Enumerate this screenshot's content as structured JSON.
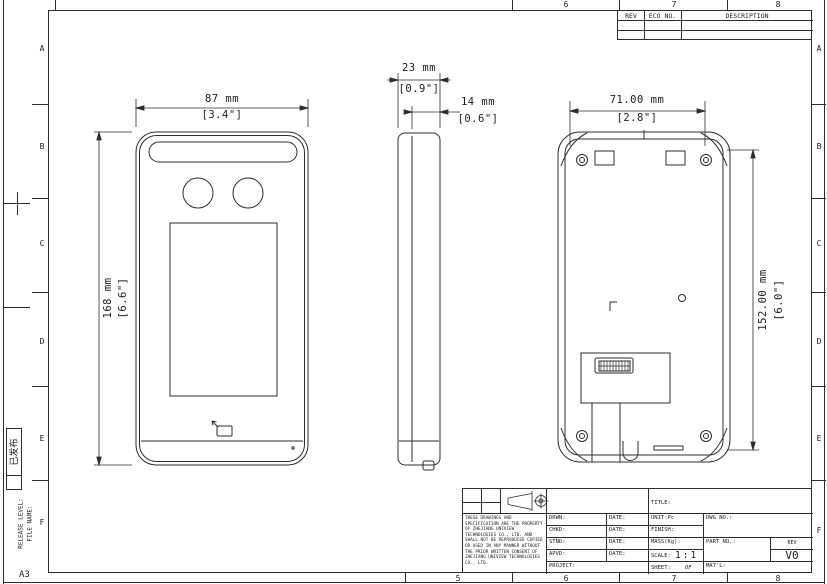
{
  "frame": {
    "sheet_size": "A3",
    "release_stamp": "已发布",
    "release_level": "RELEASE LEVEL:",
    "file_name": "FILE NAME:",
    "zones_top": [
      "6",
      "7",
      "8"
    ],
    "zones_bottom": [
      "5",
      "6",
      "7",
      "8"
    ],
    "zones_left": [
      "A",
      "B",
      "C",
      "D",
      "E",
      "F"
    ],
    "zones_right": [
      "A",
      "B",
      "C",
      "D",
      "E",
      "F"
    ]
  },
  "rev_table": {
    "col_rev": "REV",
    "col_eco": "ECO NO.",
    "col_desc": "DESCRIPTION"
  },
  "dims": {
    "front_width_mm": "87 mm",
    "front_width_in": "[3.4\"]",
    "front_height_mm": "168 mm",
    "front_height_in": "[6.6\"]",
    "depth_mm": "23 mm",
    "depth_in": "[0.9\"]",
    "body_depth_mm": "14 mm",
    "body_depth_in": "[0.6\"]",
    "back_width_mm": "71.00 mm",
    "back_width_in": "[2.8\"]",
    "back_height_mm": "152.00 mm",
    "back_height_in": "[6.0\"]"
  },
  "title_block": {
    "title_label": "TITLE:",
    "drwn_label": "DRWN:",
    "chkd_label": "CHKD:",
    "stnd_label": "STND:",
    "apvd_label": "APVD:",
    "date_label": "DATE:",
    "project_label": "PROJECT:",
    "unit_label": "UNIT:Pc",
    "finish_label": "FINISH:",
    "mass_label": "MASS(Kg):",
    "scale_label": "SCALE:",
    "scale_value": "1:1",
    "sheet_label": "SHEET:",
    "sheet_of": "OF",
    "matl_label": "MAT'L:",
    "dwg_no_label": "DWG NO.:",
    "part_no_label": "PART NO.:",
    "rev_label": "REV",
    "rev_value": "V0",
    "disclaimer": "THESE DRAWINGS AND SPECIFICATION ARE THE PROPERTY OF ZHEJIANG UNIVIEW TECHNOLOGIES CO., LTD. AND SHALL NOT BE REPRODUCED COPIED OR USED IN ANY MANNER WITHOUT THE PRIOR WRITTEN CONSENT OF ZHEJIANG UNIVIEW TECHNOLOGIES CO., LTD."
  }
}
